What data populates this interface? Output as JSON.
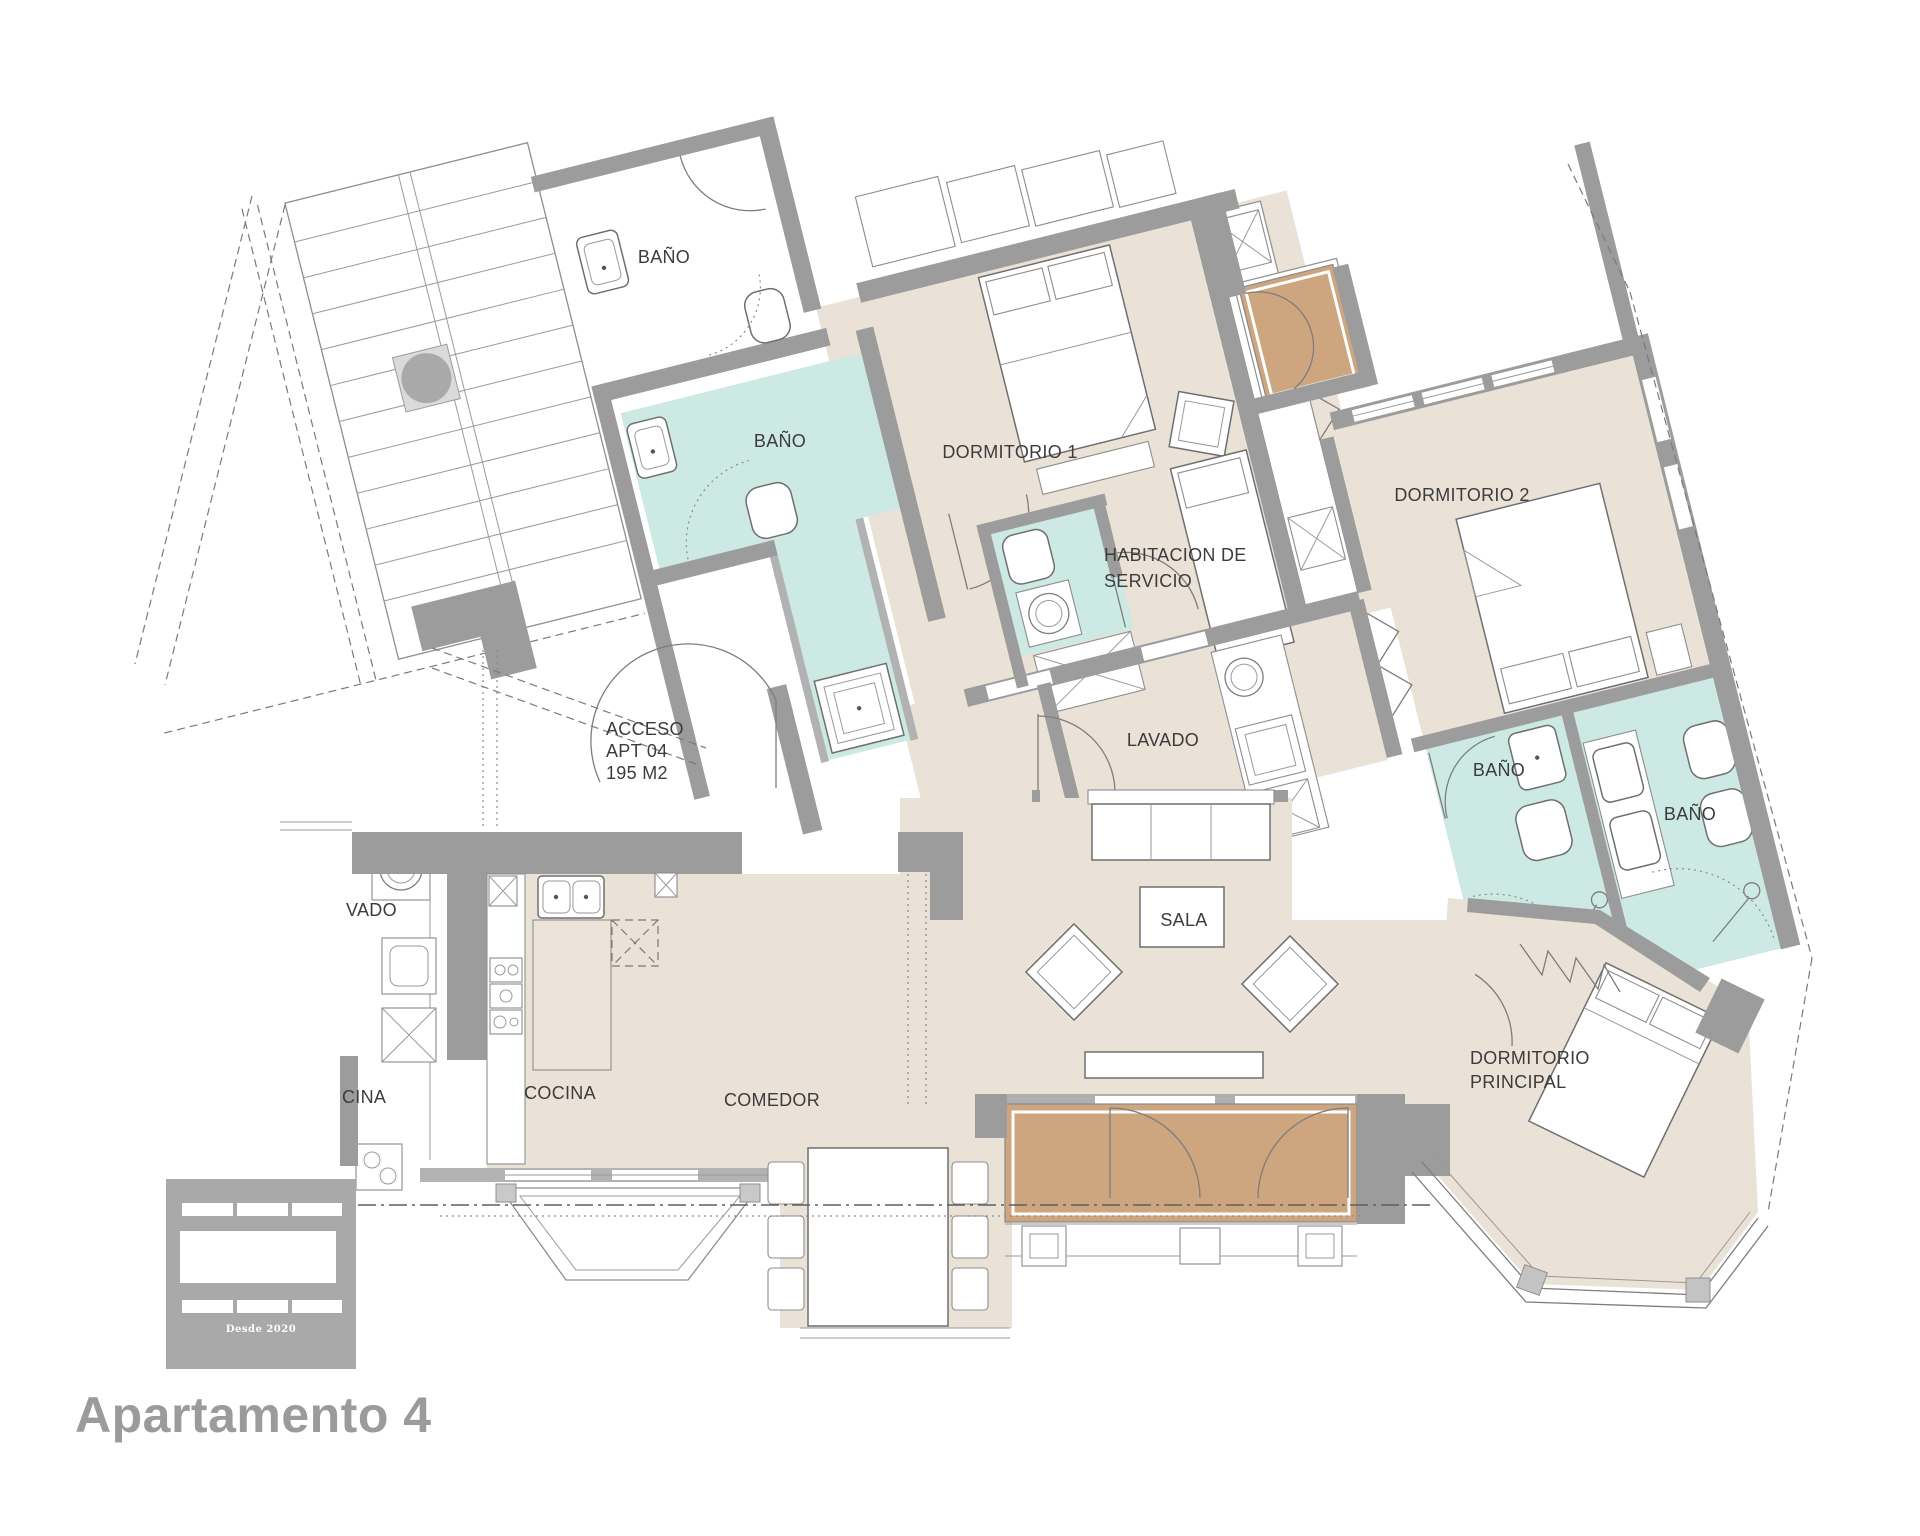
{
  "page": {
    "background": "#ffffff"
  },
  "plan": {
    "rooms": [
      {
        "id": "bano-top",
        "label": "BAÑO"
      },
      {
        "id": "bano-1",
        "label": "BAÑO"
      },
      {
        "id": "dormitorio-1",
        "label": "DORMITORIO 1"
      },
      {
        "id": "habitacion-de-servicio",
        "line1": "HABITACION DE",
        "line2": "SERVICIO"
      },
      {
        "id": "dormitorio-2",
        "label": "DORMITORIO 2"
      },
      {
        "id": "lavado",
        "label": "LAVADO"
      },
      {
        "id": "bano-2",
        "label": "BAÑO"
      },
      {
        "id": "bano-3",
        "label": "BAÑO"
      },
      {
        "id": "sala",
        "label": "SALA"
      },
      {
        "id": "cocina",
        "label": "COCINA"
      },
      {
        "id": "comedor",
        "label": "COMEDOR"
      },
      {
        "id": "dormitorio-principal",
        "line1": "DORMITORIO",
        "line2": "PRINCIPAL"
      }
    ],
    "access_note": {
      "line1": "ACCESO",
      "line2": "APT 04",
      "line3": "195 M2"
    },
    "edge_labels": {
      "lavado_partial": "VADO",
      "cocina_partial": "CINA"
    },
    "colors": {
      "floor": "#eae2d6",
      "bathroom": "#cde9e3",
      "balcony": "#cda57e",
      "walls": "#9c9c9c"
    }
  },
  "logo": {
    "tagline": "Desde 2020",
    "color": "#a9a9a9"
  },
  "footer": {
    "title": "Apartamento 4",
    "color": "#9b9b9b"
  }
}
